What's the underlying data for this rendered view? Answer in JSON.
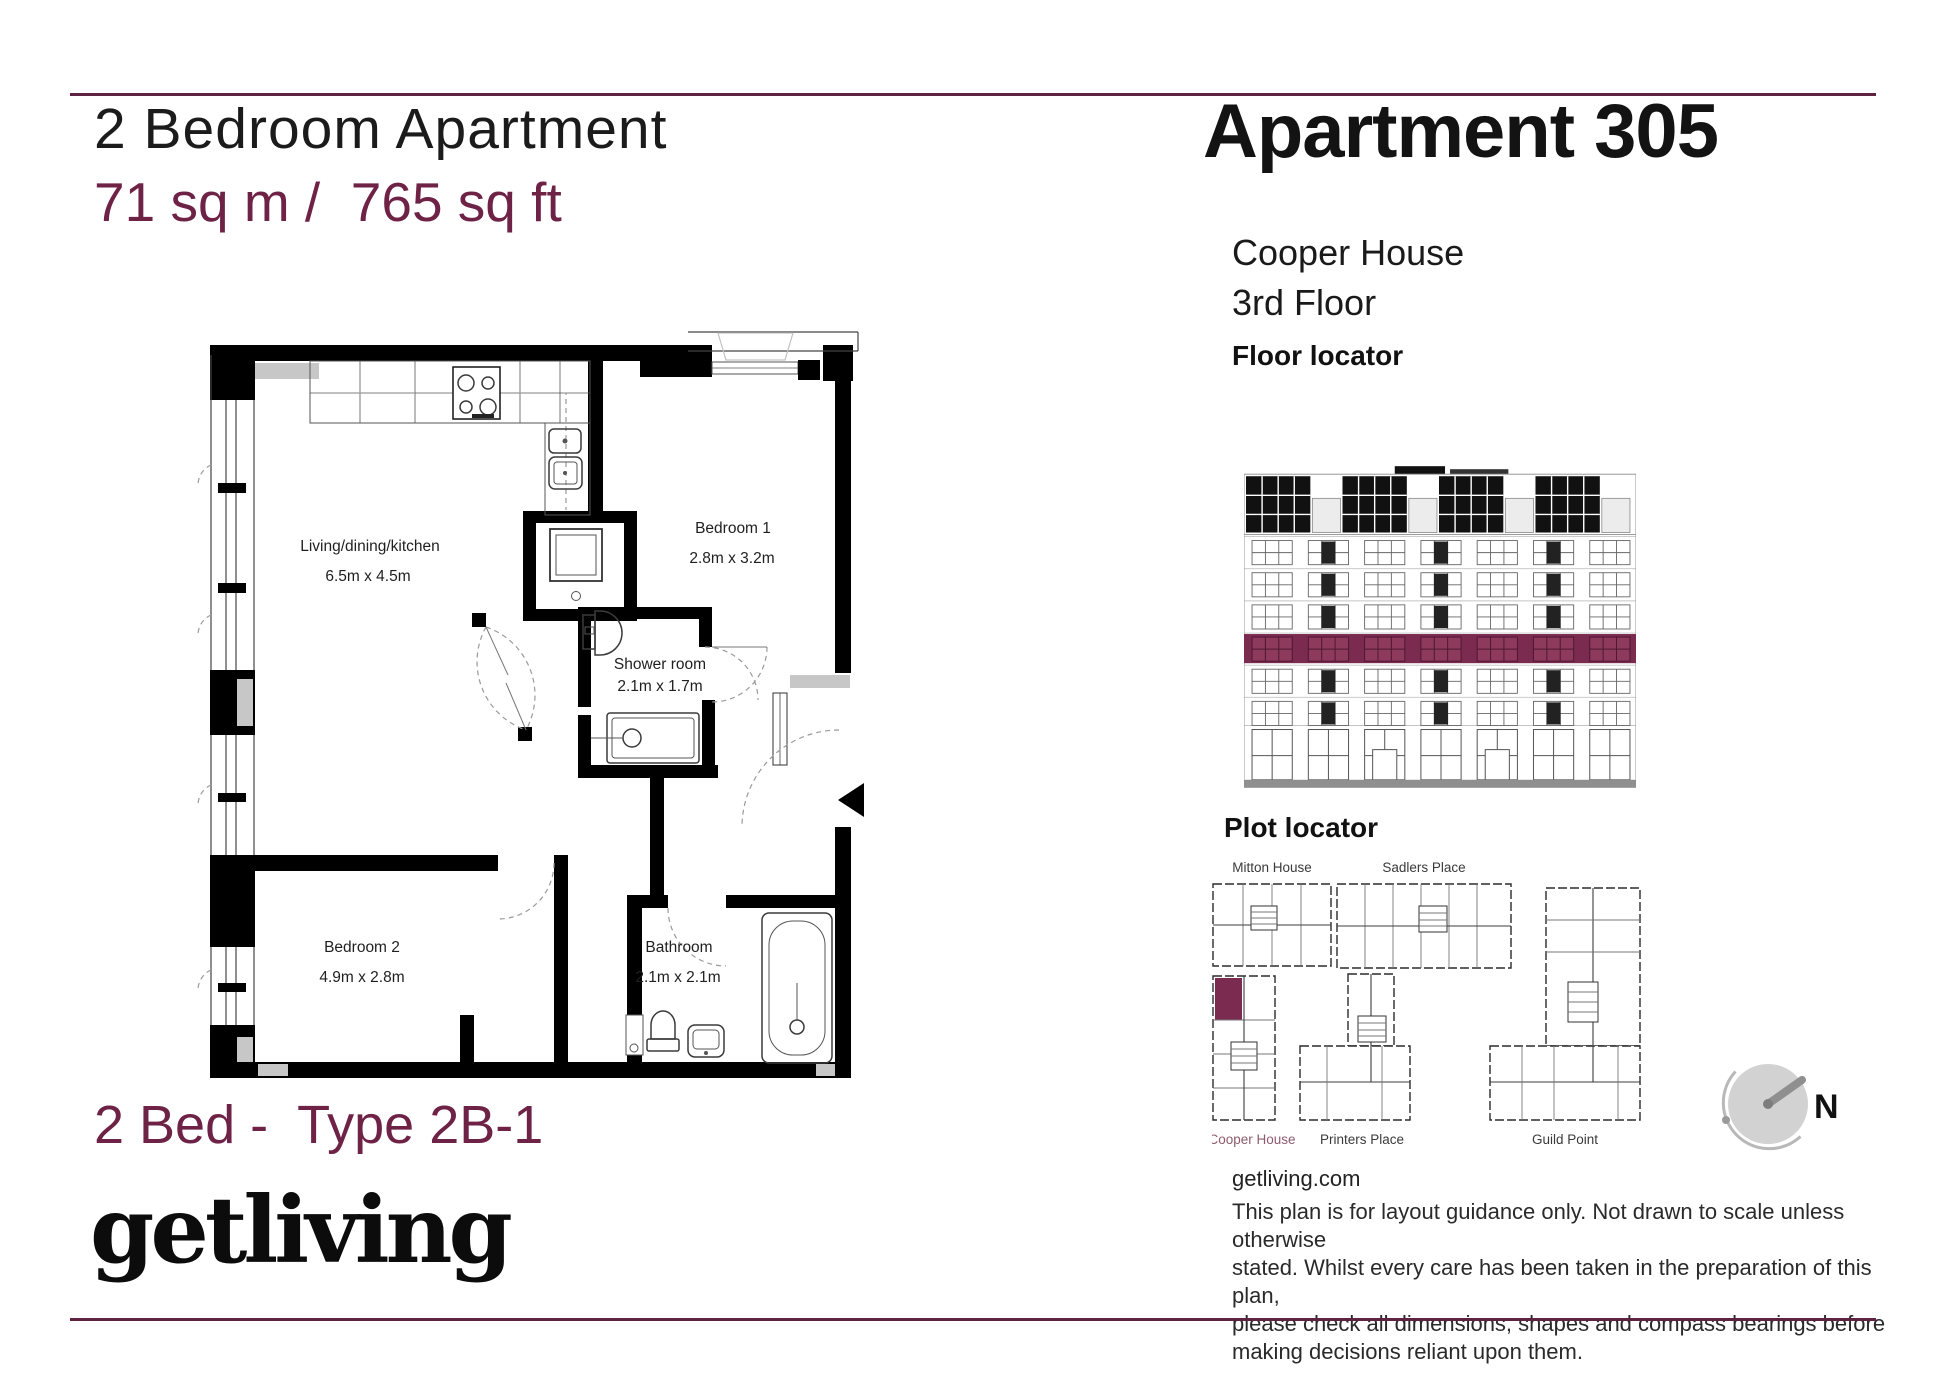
{
  "header": {
    "title": "2 Bedroom Apartment",
    "area": "71 sq m /  765 sq ft"
  },
  "apartment": {
    "name": "Apartment 305",
    "building": "Cooper House",
    "floor": "3rd Floor"
  },
  "floor_locator": {
    "heading": "Floor locator",
    "highlighted_floor": "3rd Floor",
    "highlight_color": "#7b2b50"
  },
  "plot_locator": {
    "heading": "Plot locator",
    "highlighted_building": "Cooper House",
    "buildings": [
      {
        "name": "Mitton House",
        "highlighted": false
      },
      {
        "name": "Sadlers Place",
        "highlighted": false
      },
      {
        "name": "Cooper House",
        "highlighted": true
      },
      {
        "name": "Printers Place",
        "highlighted": false
      },
      {
        "name": "Guild Point",
        "highlighted": false
      }
    ]
  },
  "compass": {
    "label": "N"
  },
  "floor_plan": {
    "rooms": [
      {
        "name": "Living/dining/kitchen",
        "dimensions": "6.5m x 4.5m"
      },
      {
        "name": "Bedroom 1",
        "dimensions": "2.8m x 3.2m"
      },
      {
        "name": "Shower room",
        "dimensions": "2.1m x 1.7m"
      },
      {
        "name": "Bedroom 2",
        "dimensions": "4.9m x 2.8m"
      },
      {
        "name": "Bathroom",
        "dimensions": "2.1m x 2.1m"
      }
    ]
  },
  "footer": {
    "type_label": "2 Bed -  Type 2B-1",
    "brand": "getliving",
    "website": "getliving.com",
    "disclaimer_lines": [
      "This plan is for layout guidance only. Not drawn to scale unless otherwise",
      "stated. Whilst every care has been taken in the preparation of this plan,",
      "please check all dimensions, shapes and compass bearings before",
      "making decisions reliant upon them."
    ]
  },
  "colors": {
    "accent": "#6e2246",
    "floor_highlight": "#7b2b50",
    "highlight_label": "#8d5b6b",
    "sill_gray": "#c7c7c7"
  }
}
